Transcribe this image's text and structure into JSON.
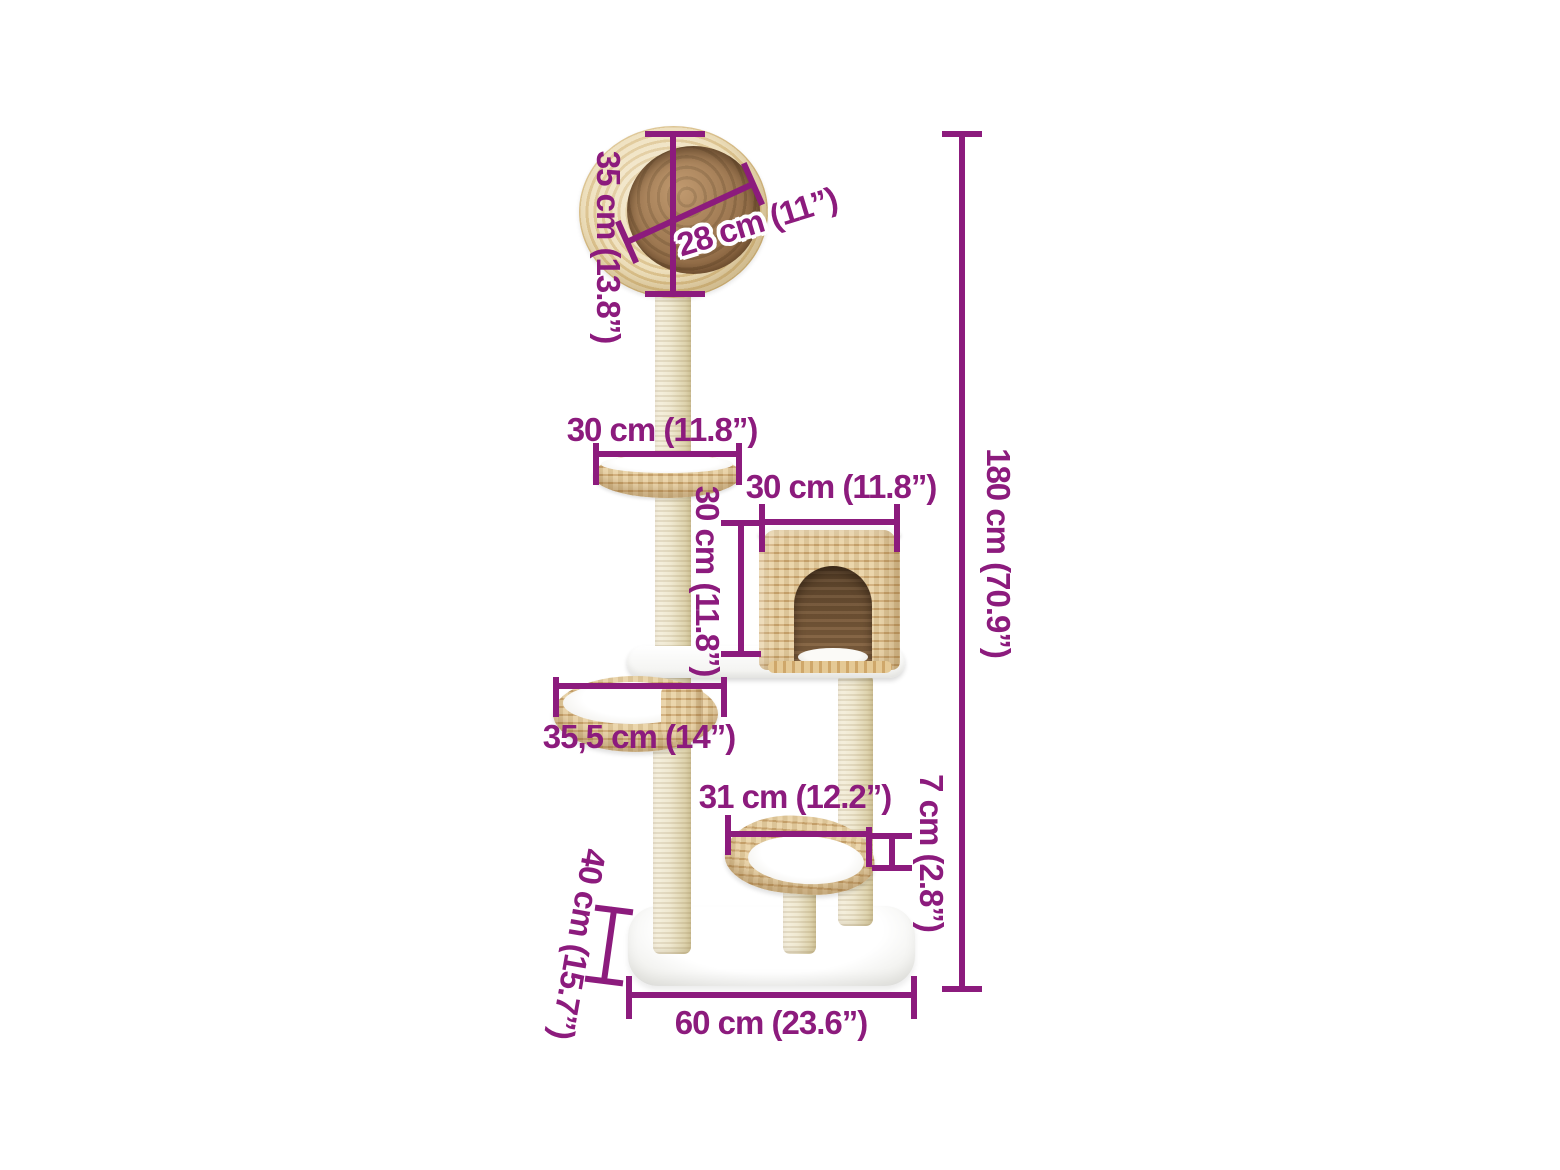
{
  "canvas": {
    "width": 1560,
    "height": 1170,
    "background": "#ffffff"
  },
  "style": {
    "accent": "#8c1b7d",
    "halo": "#ffffff",
    "sisal": "#efe8d0",
    "wicker_light": "#e8cf9f",
    "wicker_dark": "#cda76e",
    "interior_brown": "#7b5b3a"
  },
  "product": {
    "description": "seagrass cat tree with sisal scratching posts, ball bed, condo house, bowl beds and plush base"
  },
  "dimensions": [
    {
      "id": "ball-height",
      "label": "35 cm (13.8”)",
      "orientation": "vertical"
    },
    {
      "id": "ball-opening-diameter",
      "label": "28 cm (11”)",
      "orientation": "diagonal"
    },
    {
      "id": "tray-bed-width",
      "label": "30 cm (11.8”)",
      "orientation": "horizontal"
    },
    {
      "id": "house-width",
      "label": "30 cm (11.8”)",
      "orientation": "horizontal"
    },
    {
      "id": "house-height",
      "label": "30 cm (11.8”)",
      "orientation": "vertical"
    },
    {
      "id": "bowl-bed-width",
      "label": "35,5 cm (14”)",
      "orientation": "horizontal"
    },
    {
      "id": "low-bed-width",
      "label": "31 cm (12.2”)",
      "orientation": "horizontal"
    },
    {
      "id": "low-bed-height",
      "label": "7 cm (2.8”)",
      "orientation": "vertical"
    },
    {
      "id": "total-height",
      "label": "180 cm (70.9”)",
      "orientation": "vertical"
    },
    {
      "id": "base-depth",
      "label": "40 cm (15.7”)",
      "orientation": "diagonal"
    },
    {
      "id": "base-width",
      "label": "60 cm (23.6”)",
      "orientation": "horizontal"
    }
  ]
}
